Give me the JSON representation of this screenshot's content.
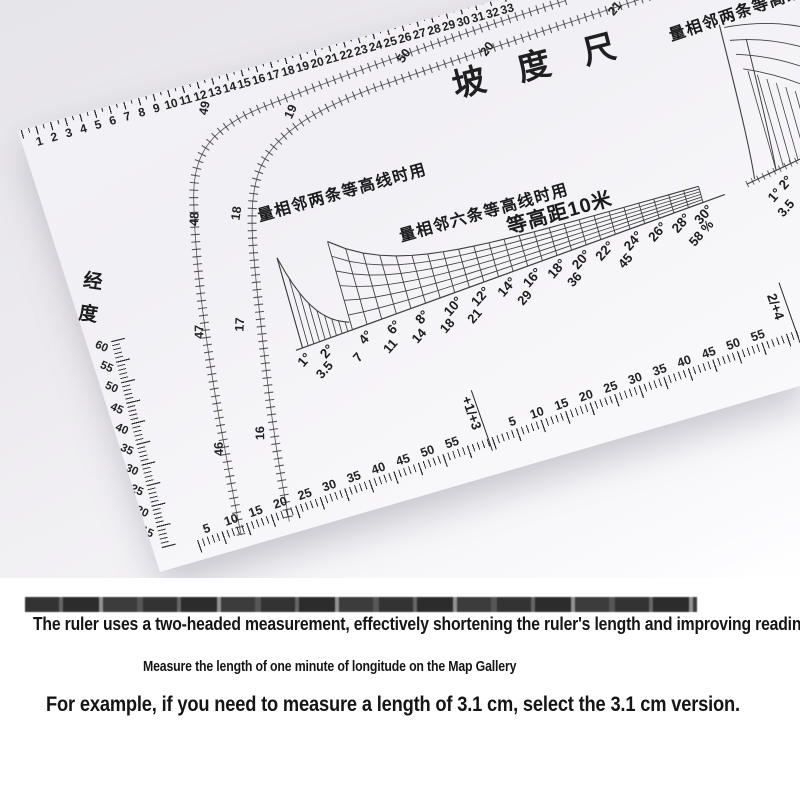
{
  "photo": {
    "title": "坡度尺",
    "labels": {
      "left_graph": "量相邻两条等高线时用",
      "mid_graph": "量相邻六条等高线时用",
      "contour_interval": "等高距10米",
      "right_graph": "量相邻两条等高线时用",
      "longitude": "经度"
    },
    "top_scale_numbers": [
      1,
      2,
      3,
      4,
      5,
      6,
      7,
      8,
      9,
      10,
      11,
      12,
      13,
      14,
      15,
      16,
      17,
      18,
      19,
      20,
      21,
      22,
      23,
      24,
      25,
      26,
      27,
      28,
      29,
      30,
      31,
      32,
      33
    ],
    "fan_scale_a": [
      "50",
      "49",
      "48",
      "47",
      "46"
    ],
    "fan_scale_b": [
      "19",
      "20",
      "21",
      "18",
      "17",
      "16"
    ],
    "left_scale_numbers": [
      "60",
      "55",
      "50",
      "45",
      "40",
      "35",
      "30",
      "25",
      "20",
      "15"
    ],
    "slope_graph": {
      "type": "slope-conversion-grid",
      "degree_labels": [
        "1°",
        "2°",
        "4°",
        "6°",
        "8°",
        "10°",
        "12°",
        "14°",
        "16°",
        "18°",
        "20°",
        "22°",
        "24°",
        "26°",
        "28°",
        "30°"
      ],
      "percent_labels": [
        "3.5",
        "7",
        "11",
        "14",
        "18",
        "21",
        "29",
        "36",
        "45",
        "58 %"
      ]
    },
    "right_graph_labels": {
      "degrees": "1° 2°",
      "percent": "3.5"
    },
    "bottom_scale": {
      "segment1": [
        "5",
        "10",
        "15",
        "20",
        "25",
        "30",
        "35",
        "40",
        "45",
        "50",
        "55"
      ],
      "divider1": "+1/+3",
      "segment2": [
        "5",
        "10",
        "15",
        "20",
        "25",
        "30",
        "35",
        "40",
        "45",
        "50",
        "55"
      ],
      "divider2": "2/+4",
      "segment3": [
        "5",
        "10",
        "15"
      ]
    }
  },
  "caption": {
    "line1": "The ruler uses a two-headed measurement, effectively shortening the ruler's length and improving reading accuracy.",
    "line2": "Measure the length of one minute of longitude on the Map Gallery",
    "line3": "For example, if you need to measure a length of 3.1 cm, select the 3.1 cm version."
  }
}
